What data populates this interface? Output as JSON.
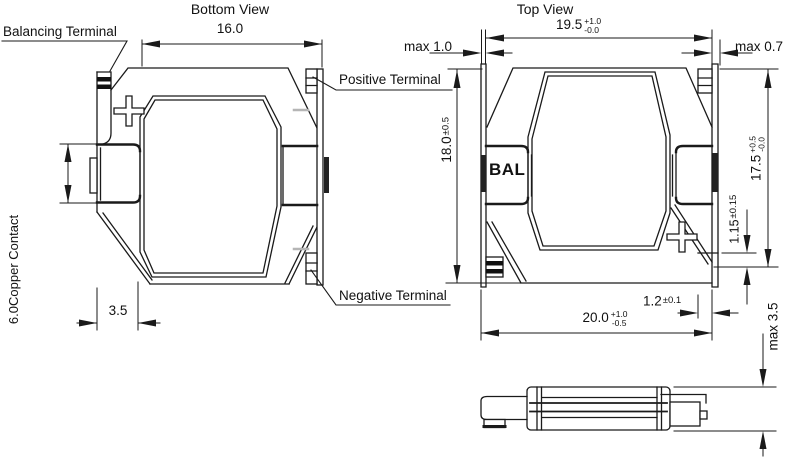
{
  "colors": {
    "background": "#ffffff",
    "line": "#1a1a1a",
    "accent_gray": "#b5b5b5"
  },
  "bottom_view": {
    "title": "Bottom View",
    "labels": {
      "balancing_terminal": "Balancing Terminal",
      "positive_terminal": "Positive Terminal",
      "negative_terminal": "Negative Terminal"
    },
    "dims": {
      "width": "16.0",
      "inset": "3.5",
      "copper_contact": "6.0Copper Contact"
    }
  },
  "top_view": {
    "title": "Top View",
    "marking": "BAL",
    "dims": {
      "top_width": {
        "value": "19.5",
        "tol_plus": "+1.0",
        "tol_minus": "-0.0"
      },
      "left_max": "max 1.0",
      "right_max": "max 0.7",
      "height": {
        "value": "18.0",
        "tol": "±0.5"
      },
      "terminal_height": {
        "value": "17.5",
        "tol_plus": "+0.5",
        "tol_minus": "-0.0"
      },
      "terminal_step": {
        "value": "1.15",
        "tol": "±0.15"
      },
      "terminal_width": {
        "value": "1.2",
        "tol": "±0.1"
      },
      "overall_width": {
        "value": "20.0",
        "tol_plus": "+1.0",
        "tol_minus": "-0.5"
      }
    }
  },
  "side_view": {
    "dims": {
      "thickness": "max 3.5"
    }
  }
}
